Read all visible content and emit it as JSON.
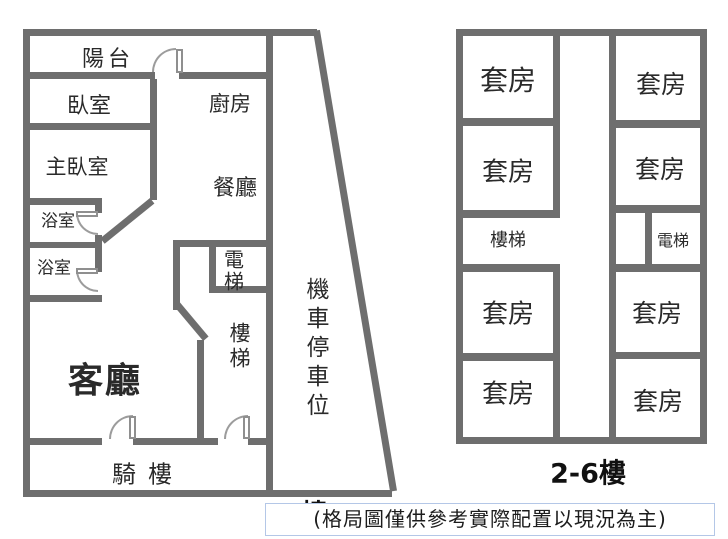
{
  "colors": {
    "wall": "#6e6e6e",
    "text": "#2a2a2a",
    "door_arc": "#9c9c9c",
    "caption_border": "#b4c7e7"
  },
  "floor1": {
    "floor_label": "1樓",
    "rooms": {
      "balcony": "陽台",
      "bedroom": "臥室",
      "master_bedroom": "主臥室",
      "bathroom_1": "浴室",
      "bathroom_2": "浴室",
      "kitchen": "廚房",
      "dining": "餐廳",
      "living": "客廳",
      "elevator": "電梯",
      "stairs": "樓梯",
      "arcade": "騎樓",
      "moto_parking": "機車停車位"
    }
  },
  "floors_2_6": {
    "floor_label": "2-6樓",
    "stairs": "樓梯",
    "elevator": "電梯",
    "suites": [
      "套房",
      "套房",
      "套房",
      "套房",
      "套房",
      "套房",
      "套房",
      "套房"
    ]
  },
  "caption": "(格局圖僅供參考實際配置以現況為主)"
}
